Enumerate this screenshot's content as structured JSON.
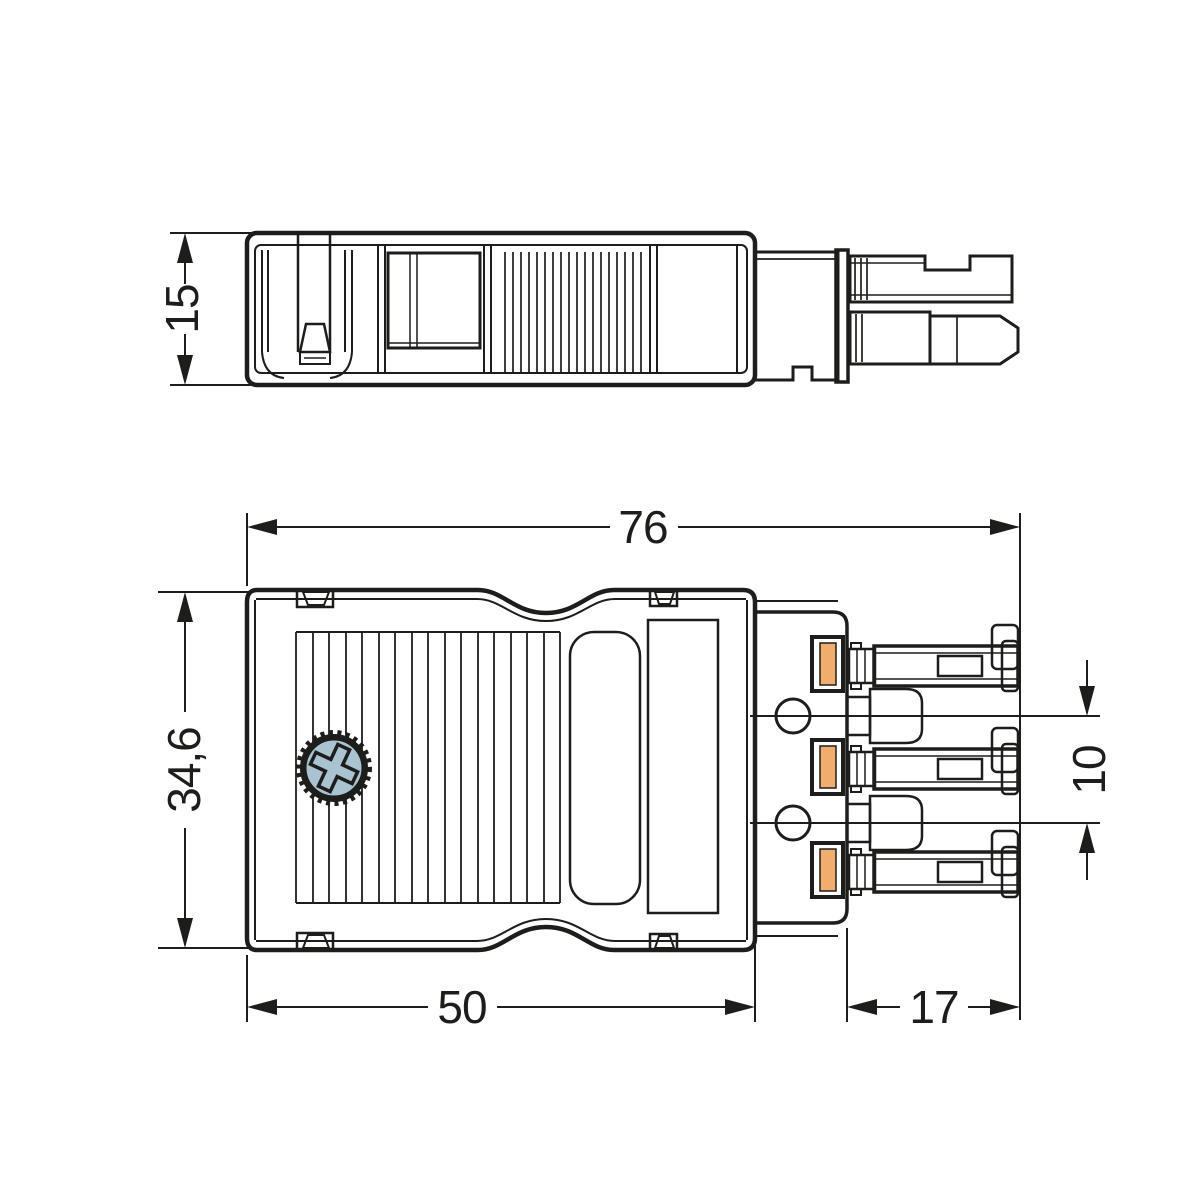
{
  "drawing": {
    "background_color": "#ffffff",
    "line_color": "#1d1d1b",
    "screw_color": "#a9c3d1",
    "terminal_color": "#f1ad6e",
    "dimensions": {
      "housing_height": {
        "value": "15",
        "orientation": "vertical",
        "view": "side-view"
      },
      "total_length": {
        "value": "76",
        "orientation": "horizontal",
        "view": "top-view"
      },
      "body_width": {
        "value": "34,6",
        "orientation": "vertical",
        "view": "top-view"
      },
      "contact_pitch": {
        "value": "10",
        "orientation": "vertical",
        "view": "top-view"
      },
      "housing_length": {
        "value": "50",
        "orientation": "horizontal",
        "view": "top-view"
      },
      "contact_length": {
        "value": "17",
        "orientation": "horizontal",
        "view": "top-view"
      }
    }
  }
}
